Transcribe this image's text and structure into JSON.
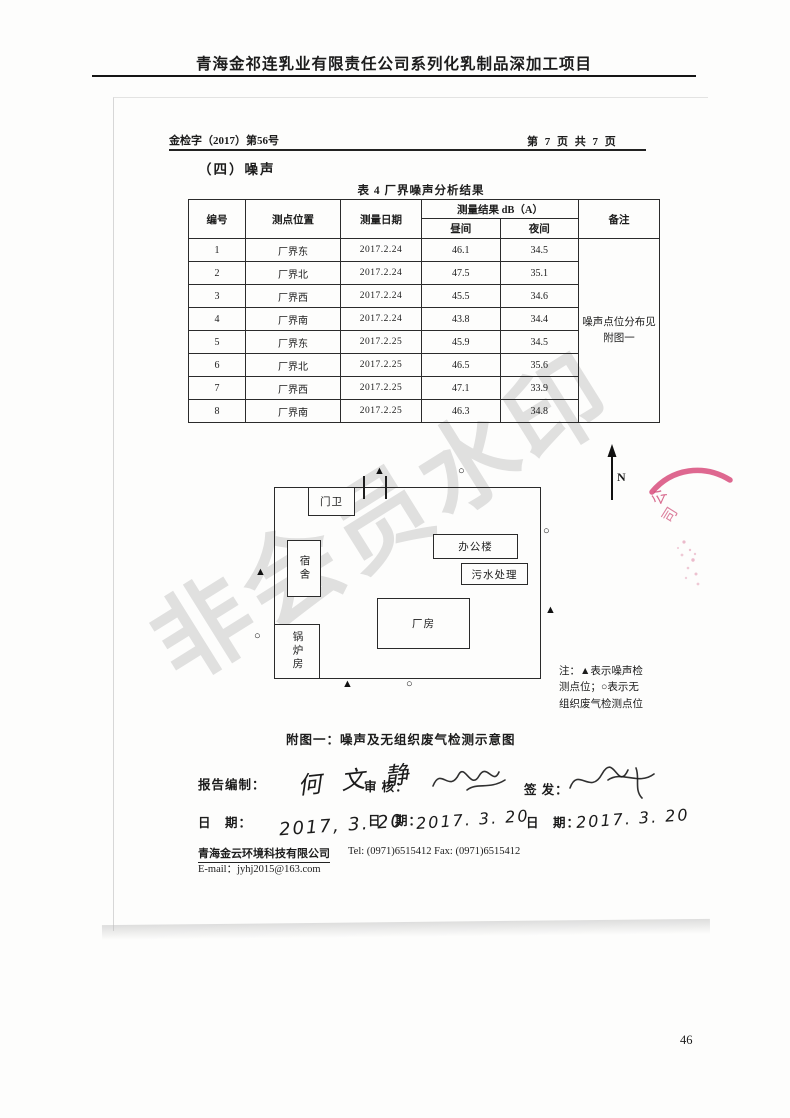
{
  "page": {
    "outer_title": "青海金祁连乳业有限责任公司系列化乳制品深加工项目",
    "page_number": "46"
  },
  "doc": {
    "doc_no": "金检字（2017）第56号",
    "page_info": "第 7 页 共 7 页",
    "section_heading": "（四）噪声"
  },
  "table": {
    "title": "表 4 厂界噪声分析结果",
    "headers": {
      "no": "编号",
      "position": "测点位置",
      "date": "测量日期",
      "result_group": "测量结果 dB（A）",
      "day": "昼间",
      "night": "夜间",
      "remark": "备注"
    },
    "remark": "噪声点位分布见附图一",
    "rows": [
      {
        "no": "1",
        "position": "厂界东",
        "date": "2017.2.24",
        "day": "46.1",
        "night": "34.5"
      },
      {
        "no": "2",
        "position": "厂界北",
        "date": "2017.2.24",
        "day": "47.5",
        "night": "35.1"
      },
      {
        "no": "3",
        "position": "厂界西",
        "date": "2017.2.24",
        "day": "45.5",
        "night": "34.6"
      },
      {
        "no": "4",
        "position": "厂界南",
        "date": "2017.2.24",
        "day": "43.8",
        "night": "34.4"
      },
      {
        "no": "5",
        "position": "厂界东",
        "date": "2017.2.25",
        "day": "45.9",
        "night": "34.5"
      },
      {
        "no": "6",
        "position": "厂界北",
        "date": "2017.2.25",
        "day": "46.5",
        "night": "35.6"
      },
      {
        "no": "7",
        "position": "厂界西",
        "date": "2017.2.25",
        "day": "47.1",
        "night": "33.9"
      },
      {
        "no": "8",
        "position": "厂界南",
        "date": "2017.2.25",
        "day": "46.3",
        "night": "34.8"
      }
    ]
  },
  "diagram": {
    "labels": {
      "gatehouse": "门卫",
      "dormitory": "宿舍",
      "office": "办公楼",
      "sewage": "污水处理",
      "workshop": "厂房",
      "boiler": "锅炉房"
    },
    "north_label": "N",
    "marker_noise": "▲",
    "marker_gas": "○",
    "note_lines": [
      "注：▲表示噪声检",
      "测点位；○表示无",
      "组织废气检测点位"
    ],
    "caption": "附图一：噪声及无组织废气检测示意图"
  },
  "signatures": {
    "prepared_label": "报告编制：",
    "prepared_name": "何 文 静",
    "review_label": "审 核：",
    "issue_label": "签 发：",
    "date_label": "日　期：",
    "prepared_date": "2017, 3. 20",
    "review_date": "2017. 3. 20",
    "issue_date": "2017. 3. 20"
  },
  "footer": {
    "company": "青海金云环境科技有限公司",
    "contact": "Tel:  (0971)6515412    Fax:  (0971)6515412",
    "email": "E-mail：jyhj2015@163.com"
  },
  "watermark": {
    "text": "非会员水印"
  },
  "stamp": {
    "char1": "公",
    "char2": "司"
  }
}
